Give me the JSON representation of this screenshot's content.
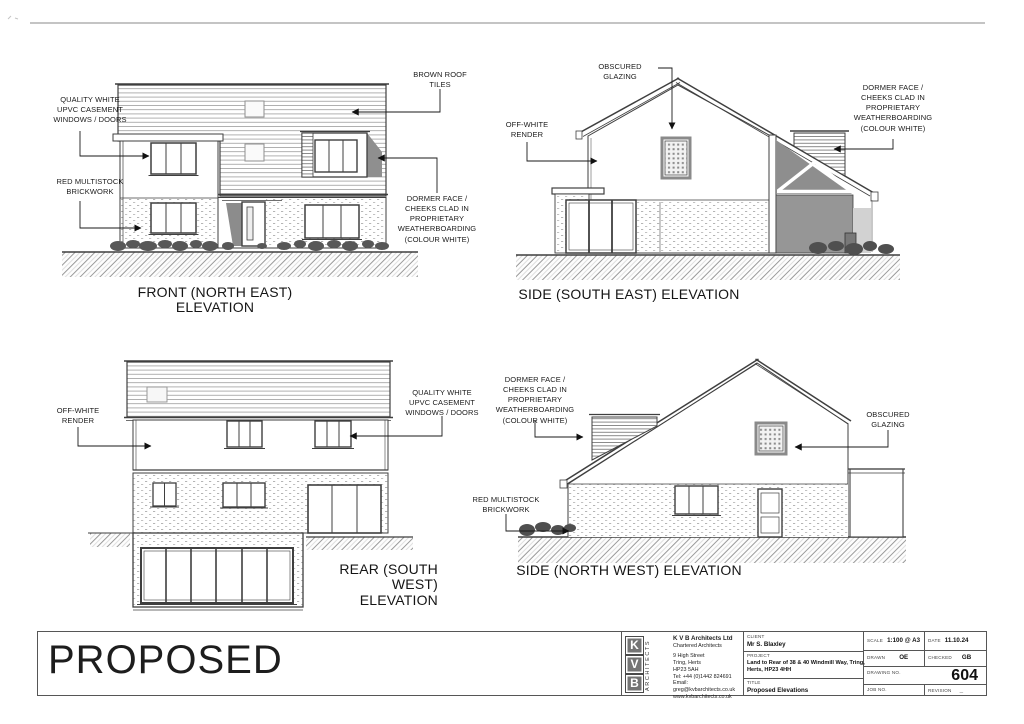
{
  "annotations": {
    "front_ne": {
      "caption": "FRONT (NORTH EAST) ELEVATION",
      "roof": "BROWN ROOF\nTILES",
      "windows": "QUALITY WHITE\nUPVC CASEMENT\nWINDOWS / DOORS",
      "brickwork": "RED MULTISTOCK\nBRICKWORK",
      "dormer": "DORMER FACE /\nCHEEKS CLAD IN\nPROPRIETARY\nWEATHERBOARDING\n(COLOUR WHITE)"
    },
    "side_se": {
      "caption": "SIDE (SOUTH EAST) ELEVATION",
      "obscured_glazing": "OBSCURED\nGLAZING",
      "render": "OFF-WHITE\nRENDER",
      "dormer": "DORMER FACE /\nCHEEKS CLAD IN\nPROPRIETARY\nWEATHERBOARDING\n(COLOUR WHITE)"
    },
    "rear_sw": {
      "caption": "REAR (SOUTH\nWEST)\nELEVATION",
      "render": "OFF-WHITE\nRENDER",
      "windows": "QUALITY WHITE\nUPVC CASEMENT\nWINDOWS / DOORS"
    },
    "side_nw": {
      "caption": "SIDE (NORTH WEST) ELEVATION",
      "dormer": "DORMER FACE /\nCHEEKS CLAD IN\nPROPRIETARY\nWEATHERBOARDING\n(COLOUR WHITE)",
      "brickwork": "RED MULTISTOCK\nBRICKWORK",
      "obscured_glazing": "OBSCURED\nGLAZING"
    }
  },
  "title_block": {
    "proposed": "PROPOSED",
    "scale_bar_label": "5m",
    "logo": {
      "letters": [
        "K",
        "V",
        "B"
      ],
      "vertical_text": "ARCHITECTS"
    },
    "firm": {
      "name": "K V B Architects Ltd",
      "tagline": "Chartered Architects",
      "address_line1": "9 High Street",
      "address_line2": "Tring, Herts",
      "address_line3": "HP23 5AH",
      "tel": "Tel:  +44 (0)1442 824691",
      "email": "Email: greg@kvbarchitects.co.uk",
      "website": "www.kvbarchitects.co.uk"
    },
    "client": {
      "label": "CLIENT",
      "value": "Mr S. Blaxley"
    },
    "project": {
      "label": "PROJECT",
      "value": "Land to Rear of 38 & 40 Windmill Way, Tring,\nHerts, HP23 4HH"
    },
    "title": {
      "label": "TITLE",
      "value": "Proposed Elevations"
    },
    "scale": {
      "label": "SCALE",
      "value": "1:100 @ A3"
    },
    "date": {
      "label": "DATE",
      "value": "11.10.24"
    },
    "drawn": {
      "label": "DRAWN",
      "value": "OE"
    },
    "checked": {
      "label": "CHECKED",
      "value": "GB"
    },
    "drawing_no": {
      "label": "DRAWING NO.",
      "value": "604"
    },
    "job_no": {
      "label": "JOB NO.",
      "value": ""
    },
    "revision": {
      "label": "REVISION",
      "value": "_"
    }
  },
  "colors": {
    "line": "#3f3f3f",
    "shadow": "#8f8f8f",
    "accent_dark_wall": "#969696",
    "paper": "#ffffff"
  }
}
